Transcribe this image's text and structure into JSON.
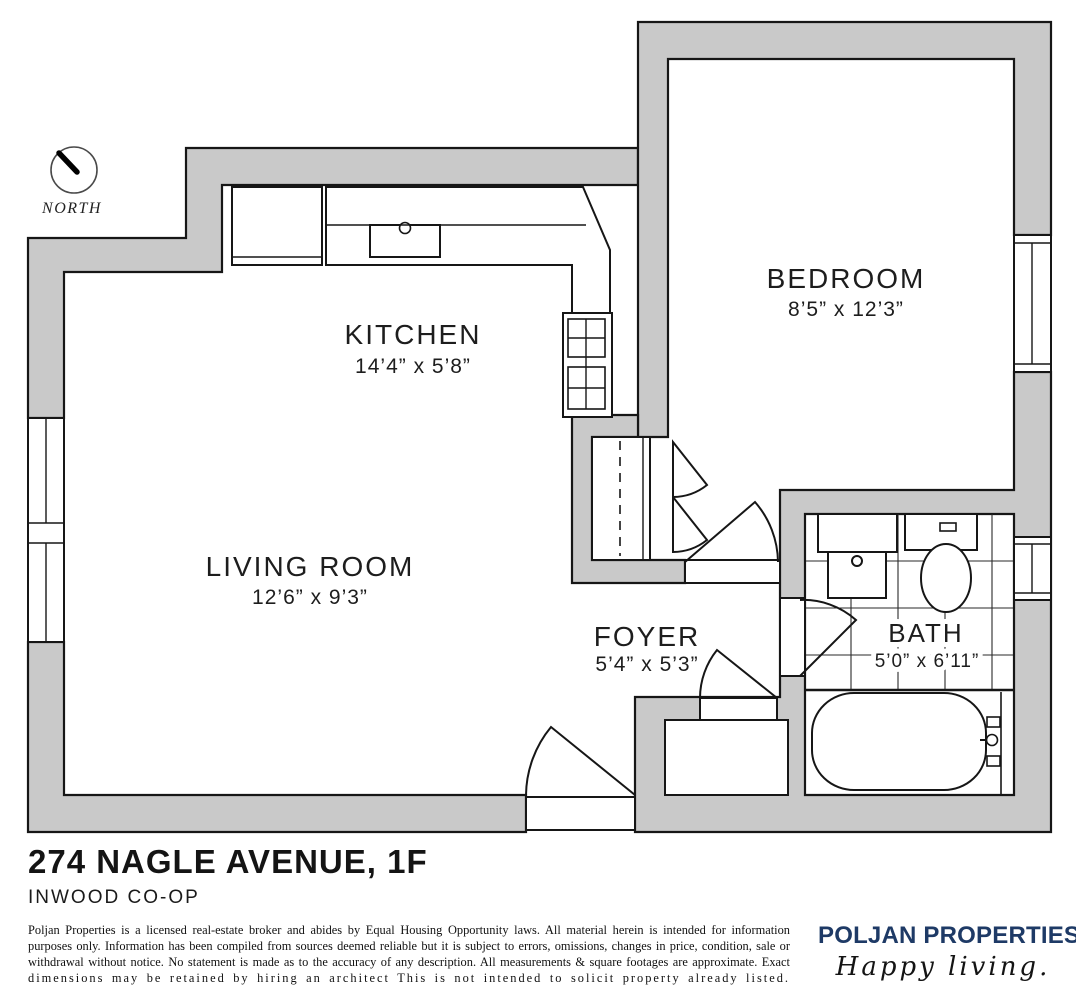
{
  "plan": {
    "north_label": "NORTH",
    "wall_color": "#c9c9c9",
    "line_color": "#161616",
    "rooms": {
      "kitchen": {
        "name": "KITCHEN",
        "dims": "14’4” x 5’8”"
      },
      "bedroom": {
        "name": "BEDROOM",
        "dims": "8’5” x 12’3”"
      },
      "living_room": {
        "name": "LIVING ROOM",
        "dims": "12’6” x 9’3”"
      },
      "foyer": {
        "name": "FOYER",
        "dims": "5’4” x 5’3”"
      },
      "bath": {
        "name": "BATH",
        "dims": "5’0” x 6’11”"
      }
    }
  },
  "title_block": {
    "address": "274 NAGLE AVENUE, 1F",
    "subtitle": "INWOOD CO-OP",
    "disclaimer_lines": [
      "Poljan Properties is a licensed real-estate broker and abides by Equal Housing Opportunity laws. All material herein is intended for information",
      "purposes only. Information has been compiled from sources deemed reliable but it is subject to errors, omissions, changes in price, condition, sale or",
      "withdrawal without notice. No statement is made as to the accuracy of any description. All measurements & square footages are approximate. Exact",
      "dimensions may be retained by hiring an architect This is not intended to solicit property already listed."
    ],
    "brand": {
      "name": "POLJAN PROPERTIES",
      "tagline": "Happy living.",
      "color": "#1e3a66"
    }
  }
}
